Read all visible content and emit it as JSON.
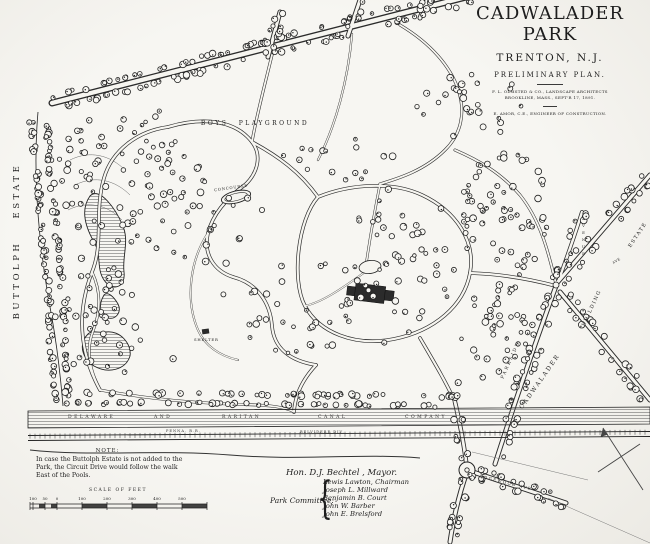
{
  "title_block": {
    "title": "CADWALADER PARK",
    "city": "TRENTON, N.J.",
    "plan_type": "PRELIMINARY PLAN.",
    "credit_line1": "F. L. OLMSTED & CO., LANDSCAPE ARCHITECTS",
    "credit_line2": "BROOKLINE, MASS., SEPT'R 17, 1891.",
    "credit_line3": "E. AMOR, C.E., ENGINEER OF CONSTRUCTION."
  },
  "map_labels": {
    "buttolph_estate": "BUTTOLPH ESTATE",
    "boys_playground": "BOYS PLAYGROUND",
    "concourse": "CONCOURSE",
    "shelter": "SHELTER",
    "parkside": "PARKSIDE",
    "avenue": "AVENUE",
    "cadwalader": "CADWALADER",
    "building": "BUILDING",
    "ave": "AVE",
    "estate": "ESTATE",
    "edgewood_ave": "EDGEWOOD AVE"
  },
  "canal": {
    "words": [
      "DELAWARE",
      "AND",
      "RARITAN",
      "CANAL",
      "COMPANY"
    ],
    "railroad": "PENNA. R.R.",
    "railroad_division": "BELVIDERE DIV."
  },
  "note": {
    "heading": "NOTE:",
    "body": "In case the Buttolph Estate is not added to the Park, the Circuit Drive would follow the walk East of the Pools."
  },
  "scale": {
    "label": "SCALE OF FEET",
    "ticks": [
      "100",
      "50",
      "0",
      "100",
      "200",
      "300",
      "400",
      "500"
    ]
  },
  "officials": {
    "mayor": "Hon. D.J. Bechtel , Mayor.",
    "committee_label": "Park Committee:",
    "brace": "{",
    "committee": [
      "Lewis Lawton, Chairman",
      "Joseph L. Millward",
      "Benjamin B. Court",
      "John W. Barber",
      "John E. Brelsford"
    ]
  },
  "colors": {
    "ink": "#222222",
    "paper": "#f5f4ef"
  }
}
